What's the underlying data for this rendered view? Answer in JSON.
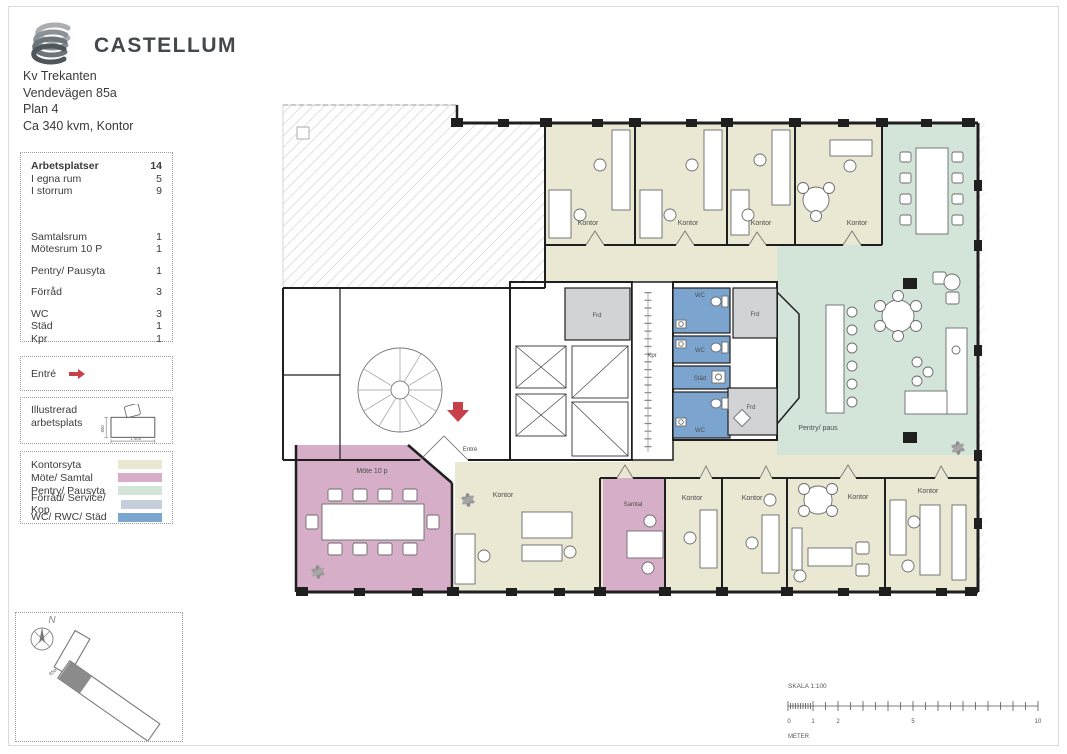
{
  "page": {
    "sheet_bg": "#ffffff"
  },
  "header": {
    "company": "CASTELLUM",
    "project": [
      "Kv Trekanten",
      "Vendevägen 85a",
      "Plan 4",
      "Ca 340 kvm, Kontor"
    ]
  },
  "facts": {
    "rows": [
      {
        "label": "Arbetsplatser",
        "value": "14"
      },
      {
        "label": "I egna rum",
        "value": "5"
      },
      {
        "label": "I storrum",
        "value": "9"
      },
      {
        "label": "Samtalsrum",
        "value": "1"
      },
      {
        "label": "Mötesrum 10 P",
        "value": "1"
      },
      {
        "label": "Pentry/ Pausyta",
        "value": "1"
      },
      {
        "label": "Förråd",
        "value": "3"
      },
      {
        "label": "WC",
        "value": "3"
      },
      {
        "label": "Städ",
        "value": "1"
      },
      {
        "label": "Kpr",
        "value": "1"
      }
    ]
  },
  "entre_key": {
    "label": "Entré"
  },
  "workstation_key": {
    "line1": "Illustrerad",
    "line2": "arbetsplats",
    "width_label": "1 600",
    "depth_label": "800"
  },
  "area_legend": {
    "items": [
      {
        "label": "Kontorsyta",
        "color": "#eae7d3"
      },
      {
        "label": "Möte/ Samtal",
        "color": "#d6aec7"
      },
      {
        "label": "Pentry/ Pausyta",
        "color": "#d3e5d9"
      },
      {
        "label": "Förråd/ Service/ Kop",
        "color": "#c5cfdc"
      },
      {
        "label": "WC/ RWC/ Städ",
        "color": "#7ba4cf"
      }
    ]
  },
  "plan": {
    "room_labels": {
      "kontor_top_1": "Kontor",
      "kontor_top_2": "Kontor",
      "kontor_top_3": "Kontor",
      "kontor_top_4": "Kontor",
      "frd_core": "Frd",
      "kpr": "Kpr",
      "wc_1": "WC",
      "wc_2": "WC",
      "stad": "Städ",
      "wc_3": "WC",
      "frd_right_1": "Frd",
      "frd_right_2": "Frd",
      "pentry": "Pentry/ paus",
      "mote": "Möte 10 p",
      "entre": "Entré",
      "kontor_open": "Kontor",
      "samtal": "Samtal",
      "kontor_b1": "Kontor",
      "kontor_b2": "Kontor",
      "kontor_b3": "Kontor",
      "kontor_b4": "Kontor"
    }
  },
  "siteplan": {
    "north_label": "N",
    "entrance_label": "85a"
  },
  "scalebar": {
    "title": "SKALA 1:100",
    "unit": "METER",
    "ticks": [
      "0",
      "1",
      "2",
      "5",
      "10"
    ]
  }
}
